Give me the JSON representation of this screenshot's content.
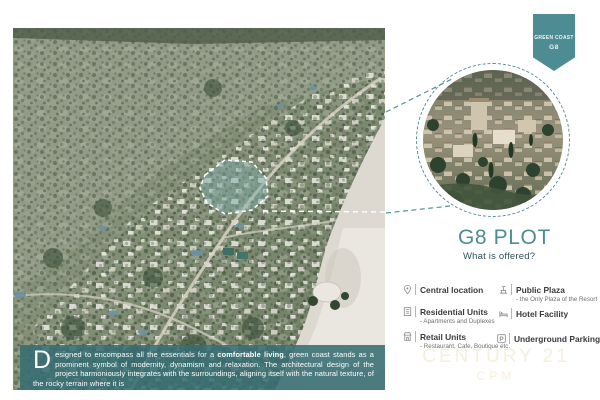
{
  "badge": {
    "line1": "GREEN COAST",
    "line2": "G8"
  },
  "panel": {
    "title": "G8 PLOT",
    "subtitle": "What is offered?",
    "offerings": [
      {
        "icon": "location-icon",
        "label": "Central location",
        "note": ""
      },
      {
        "icon": "residential-icon",
        "label": "Residential Units",
        "note": "- Apartments and Duplexes"
      },
      {
        "icon": "retail-icon",
        "label": "Retail Units",
        "note": "- Restaurant, Cafe, Boutique etc."
      },
      {
        "icon": "plaza-icon",
        "label": "Public Plaza",
        "note": "- the Only Plaza of the Resort"
      },
      {
        "icon": "hotel-icon",
        "label": "Hotel Facility",
        "note": ""
      },
      {
        "icon": "parking-icon",
        "label": "Underground Parking",
        "note": ""
      }
    ]
  },
  "banner": {
    "dropcap": "D",
    "text_before_bold": "esigned to encompass all the essentials for a ",
    "bold_text": "comfortable living",
    "text_after_bold": ", green coast stands as a prominent symbol of modernity, dynamism and relaxation. The architectural design of the project harmoniously integrates with the surroundings, aligning itself with the natural texture, of the rocky terrain where it is"
  },
  "watermark": {
    "line1": "CENTURY 21",
    "line2": "CPM"
  },
  "colors": {
    "accent_teal": "#4e8c94",
    "banner_overlay": "#366d73",
    "watermark_gold": "#efe2bd",
    "plot_highlight": "#7daaa8"
  }
}
